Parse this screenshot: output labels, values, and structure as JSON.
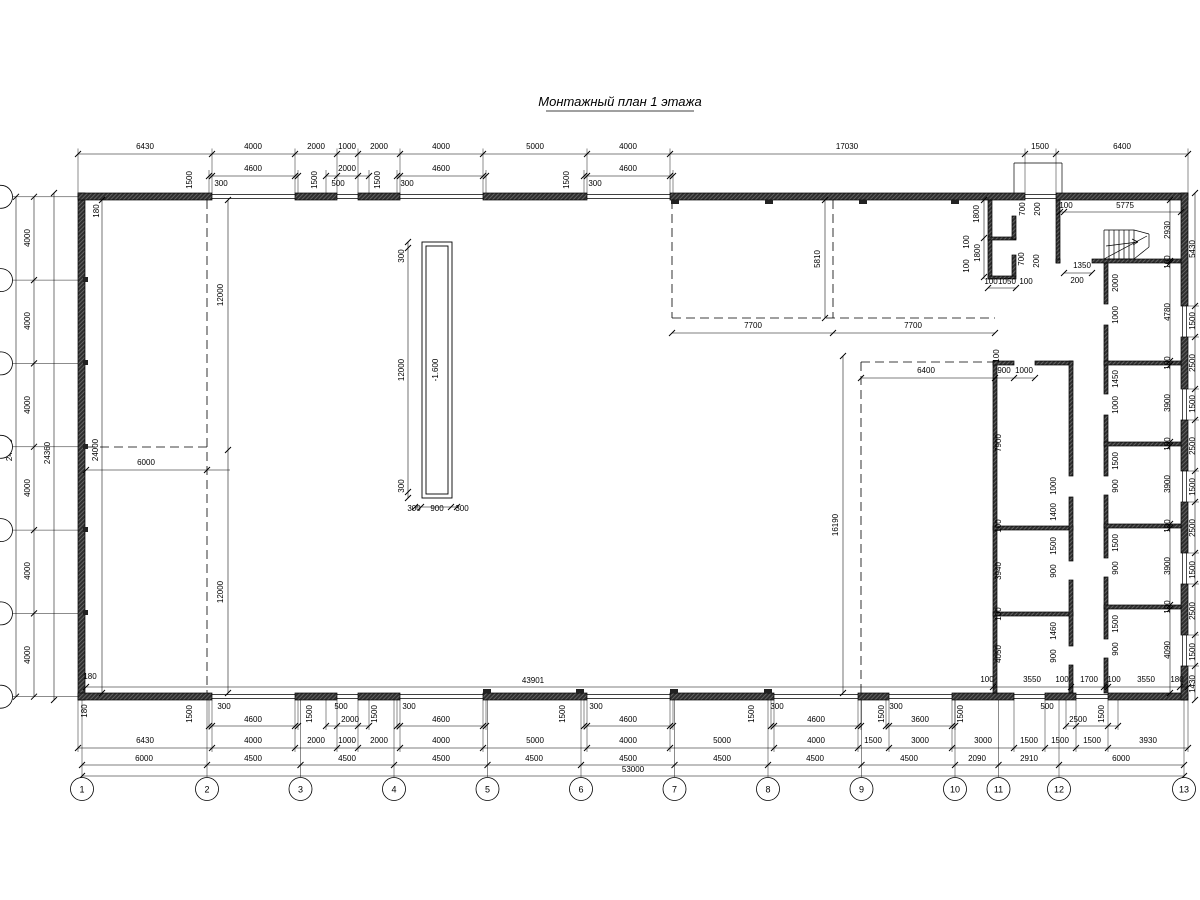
{
  "title": "Монтажный план 1 этажа",
  "colors": {
    "background": "#ffffff",
    "line": "#000000",
    "wall_fill": "#2e2e2e"
  },
  "pit_level": "-1.600",
  "axes_bottom": [
    {
      "n": "1",
      "x": 82
    },
    {
      "n": "2",
      "x": 207
    },
    {
      "n": "3",
      "x": 300.5
    },
    {
      "n": "4",
      "x": 394
    },
    {
      "n": "5",
      "x": 487.5
    },
    {
      "n": "6",
      "x": 581
    },
    {
      "n": "7",
      "x": 674.5
    },
    {
      "n": "8",
      "x": 768
    },
    {
      "n": "9",
      "x": 861.5
    },
    {
      "n": "10",
      "x": 955
    },
    {
      "n": "11",
      "x": 998.5
    },
    {
      "n": "12",
      "x": 1059
    },
    {
      "n": "13",
      "x": 1184
    }
  ],
  "axes_left_y": [
    196.8,
    280.1,
    363.4,
    446.8,
    530.1,
    613.4,
    696.7
  ],
  "labels": [
    [
      145,
      149,
      "6430"
    ],
    [
      253,
      149,
      "4000"
    ],
    [
      316,
      149,
      "2000"
    ],
    [
      347,
      149,
      "1000"
    ],
    [
      379,
      149,
      "2000"
    ],
    [
      441,
      149,
      "4000"
    ],
    [
      535,
      149,
      "5000"
    ],
    [
      628,
      149,
      "4000"
    ],
    [
      847,
      149,
      "17030"
    ],
    [
      1040,
      149,
      "1500"
    ],
    [
      1122,
      149,
      "6400"
    ],
    [
      253,
      171,
      "4600"
    ],
    [
      347,
      171,
      "2000"
    ],
    [
      441,
      171,
      "4600"
    ],
    [
      628,
      171,
      "4600"
    ],
    [
      221,
      186,
      "300"
    ],
    [
      338,
      186,
      "500"
    ],
    [
      407,
      186,
      "300"
    ],
    [
      595,
      186,
      "300"
    ],
    [
      192,
      180,
      "1500",
      1
    ],
    [
      317,
      180,
      "1500",
      1
    ],
    [
      380,
      180,
      "1500",
      1
    ],
    [
      569,
      180,
      "1500",
      1
    ],
    [
      99,
      211,
      "180",
      1
    ],
    [
      12,
      450,
      "24000",
      1
    ],
    [
      30,
      238,
      "4000",
      1
    ],
    [
      30,
      321,
      "4000",
      1
    ],
    [
      30,
      405,
      "4000",
      1
    ],
    [
      30,
      488,
      "4000",
      1
    ],
    [
      30,
      571,
      "4000",
      1
    ],
    [
      30,
      655,
      "4000",
      1
    ],
    [
      50,
      453,
      "24360",
      1
    ],
    [
      98,
      450,
      "24000",
      1
    ],
    [
      90,
      679,
      "180"
    ],
    [
      87,
      711,
      "180",
      1
    ],
    [
      223,
      295,
      "12000",
      1
    ],
    [
      223,
      592,
      "12000",
      1
    ],
    [
      146,
      465,
      "6000"
    ],
    [
      404,
      256,
      "300",
      1
    ],
    [
      404,
      370,
      "12000",
      1
    ],
    [
      404,
      486,
      "300",
      1
    ],
    [
      414,
      511,
      "300"
    ],
    [
      437,
      511,
      "900"
    ],
    [
      462,
      511,
      "300"
    ],
    [
      438,
      370,
      "-1.600",
      1
    ],
    [
      820,
      259,
      "5810",
      1
    ],
    [
      753,
      328,
      "7700"
    ],
    [
      913,
      328,
      "7700"
    ],
    [
      979,
      214,
      "1800",
      1
    ],
    [
      969,
      242,
      "100",
      1
    ],
    [
      980,
      253,
      "1800",
      1
    ],
    [
      969,
      266,
      "100",
      1
    ],
    [
      1025,
      209,
      "700",
      1
    ],
    [
      1040,
      209,
      "200",
      1
    ],
    [
      1024,
      259,
      "700",
      1
    ],
    [
      1039,
      261,
      "200",
      1
    ],
    [
      991,
      284,
      "100"
    ],
    [
      1007,
      284,
      "1050"
    ],
    [
      1026,
      284,
      "100"
    ],
    [
      1066,
      208,
      "100"
    ],
    [
      1125,
      208,
      "5775"
    ],
    [
      1082,
      268,
      "1350"
    ],
    [
      1077,
      283,
      "200"
    ],
    [
      1170,
      230,
      "2930",
      1
    ],
    [
      926,
      373,
      "6400"
    ],
    [
      1004,
      373,
      "900"
    ],
    [
      1024,
      373,
      "1000"
    ],
    [
      999,
      356,
      "100",
      1
    ],
    [
      838,
      525,
      "16190",
      1
    ],
    [
      1001,
      443,
      "7900",
      1
    ],
    [
      1001,
      526,
      "100",
      1
    ],
    [
      1001,
      571,
      "3940",
      1
    ],
    [
      1001,
      614,
      "100",
      1
    ],
    [
      1001,
      654,
      "4050",
      1
    ],
    [
      1056,
      486,
      "1000",
      1
    ],
    [
      1056,
      512,
      "1400",
      1
    ],
    [
      1056,
      546,
      "1500",
      1
    ],
    [
      1056,
      571,
      "900",
      1
    ],
    [
      1056,
      631,
      "1460",
      1
    ],
    [
      1056,
      656,
      "900",
      1
    ],
    [
      1118,
      283,
      "2000",
      1
    ],
    [
      1118,
      315,
      "1000",
      1
    ],
    [
      1118,
      379,
      "1450",
      1
    ],
    [
      1118,
      405,
      "1000",
      1
    ],
    [
      1118,
      461,
      "1500",
      1
    ],
    [
      1118,
      486,
      "900",
      1
    ],
    [
      1118,
      543,
      "1500",
      1
    ],
    [
      1118,
      568,
      "900",
      1
    ],
    [
      1118,
      624,
      "1500",
      1
    ],
    [
      1118,
      649,
      "900",
      1
    ],
    [
      1170,
      262,
      "100",
      1
    ],
    [
      1170,
      312,
      "4780",
      1
    ],
    [
      1170,
      363,
      "100",
      1
    ],
    [
      1170,
      403,
      "3900",
      1
    ],
    [
      1170,
      444,
      "100",
      1
    ],
    [
      1170,
      484,
      "3900",
      1
    ],
    [
      1170,
      526,
      "100",
      1
    ],
    [
      1170,
      566,
      "3900",
      1
    ],
    [
      1170,
      607,
      "100",
      1
    ],
    [
      1170,
      650,
      "4090",
      1
    ],
    [
      1195,
      249,
      "5430",
      1
    ],
    [
      1195,
      321,
      "1500",
      1
    ],
    [
      1195,
      363,
      "2500",
      1
    ],
    [
      1195,
      404,
      "1500",
      1
    ],
    [
      1195,
      446,
      "2500",
      1
    ],
    [
      1195,
      487,
      "1500",
      1
    ],
    [
      1195,
      528,
      "2500",
      1
    ],
    [
      1195,
      570,
      "1500",
      1
    ],
    [
      1195,
      611,
      "2500",
      1
    ],
    [
      1195,
      652,
      "1500",
      1
    ],
    [
      1195,
      684,
      "1430",
      1
    ],
    [
      533,
      683,
      "43901"
    ],
    [
      987,
      682,
      "100"
    ],
    [
      1032,
      682,
      "3550"
    ],
    [
      1062,
      682,
      "100"
    ],
    [
      1089,
      682,
      "1700"
    ],
    [
      1114,
      682,
      "100"
    ],
    [
      1146,
      682,
      "3550"
    ],
    [
      1177,
      682,
      "180"
    ],
    [
      192,
      714,
      "1500",
      1
    ],
    [
      312,
      714,
      "1500",
      1
    ],
    [
      377,
      714,
      "1500",
      1
    ],
    [
      565,
      714,
      "1500",
      1
    ],
    [
      754,
      714,
      "1500",
      1
    ],
    [
      884,
      714,
      "1500",
      1
    ],
    [
      963,
      714,
      "1500",
      1
    ],
    [
      1104,
      714,
      "1500",
      1
    ],
    [
      224,
      709,
      "300"
    ],
    [
      341,
      709,
      "500"
    ],
    [
      409,
      709,
      "300"
    ],
    [
      596,
      709,
      "300"
    ],
    [
      777,
      709,
      "300"
    ],
    [
      896,
      709,
      "300"
    ],
    [
      1047,
      709,
      "500"
    ],
    [
      253,
      722,
      "4600"
    ],
    [
      350,
      722,
      "2000"
    ],
    [
      441,
      722,
      "4600"
    ],
    [
      628,
      722,
      "4600"
    ],
    [
      816,
      722,
      "4600"
    ],
    [
      920,
      722,
      "3600"
    ],
    [
      1078,
      722,
      "2500"
    ],
    [
      145,
      743,
      "6430"
    ],
    [
      253,
      743,
      "4000"
    ],
    [
      316,
      743,
      "2000"
    ],
    [
      347,
      743,
      "1000"
    ],
    [
      379,
      743,
      "2000"
    ],
    [
      441,
      743,
      "4000"
    ],
    [
      535,
      743,
      "5000"
    ],
    [
      628,
      743,
      "4000"
    ],
    [
      722,
      743,
      "5000"
    ],
    [
      816,
      743,
      "4000"
    ],
    [
      873,
      743,
      "1500"
    ],
    [
      920,
      743,
      "3000"
    ],
    [
      983,
      743,
      "3000"
    ],
    [
      1029,
      743,
      "1500"
    ],
    [
      1060,
      743,
      "1500"
    ],
    [
      1092,
      743,
      "1500"
    ],
    [
      1148,
      743,
      "3930"
    ],
    [
      144,
      761,
      "6000"
    ],
    [
      253,
      761,
      "4500"
    ],
    [
      347,
      761,
      "4500"
    ],
    [
      441,
      761,
      "4500"
    ],
    [
      534,
      761,
      "4500"
    ],
    [
      628,
      761,
      "4500"
    ],
    [
      722,
      761,
      "4500"
    ],
    [
      815,
      761,
      "4500"
    ],
    [
      909,
      761,
      "4500"
    ],
    [
      977,
      761,
      "2090"
    ],
    [
      1029,
      761,
      "2910"
    ],
    [
      1121,
      761,
      "6000"
    ],
    [
      633,
      772,
      "53000"
    ]
  ]
}
